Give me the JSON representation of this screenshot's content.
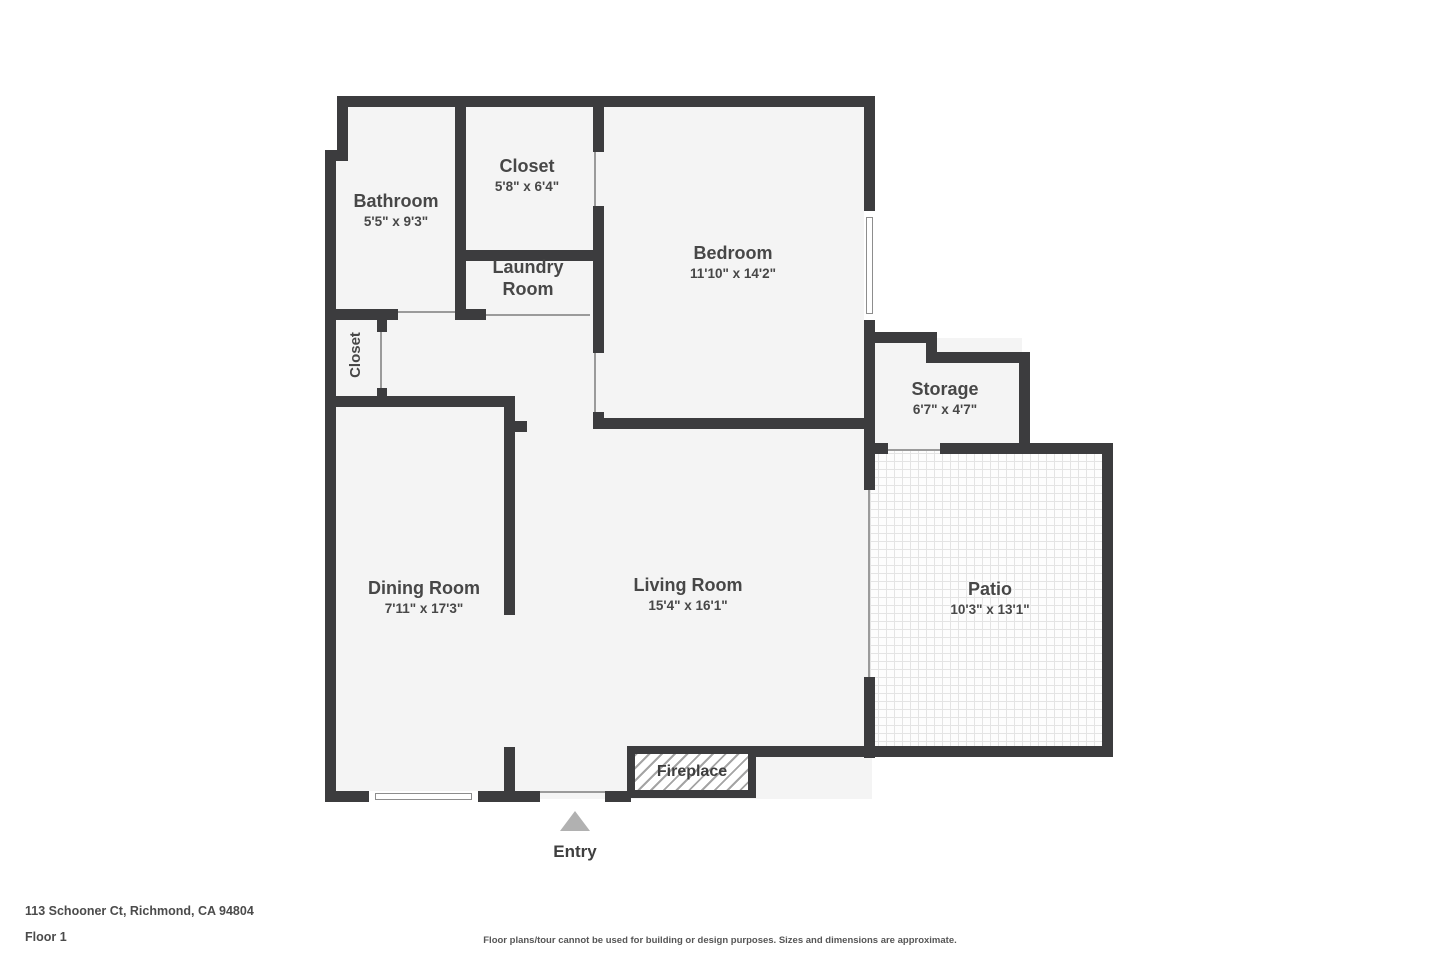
{
  "meta": {
    "type": "floor-plan"
  },
  "rooms": {
    "bathroom": {
      "name": "Bathroom",
      "dims": "5'5\" x 9'3\""
    },
    "bedroom_closet": {
      "name": "Closet",
      "dims": "5'8\" x 6'4\""
    },
    "laundry": {
      "name": "Laundry Room"
    },
    "bedroom": {
      "name": "Bedroom",
      "dims": "11'10\" x 14'2\""
    },
    "hall_closet": {
      "name": "Closet"
    },
    "storage": {
      "name": "Storage",
      "dims": "6'7\" x 4'7\""
    },
    "dining": {
      "name": "Dining Room",
      "dims": "7'11\" x 17'3\""
    },
    "living": {
      "name": "Living Room",
      "dims": "15'4\" x 16'1\""
    },
    "patio": {
      "name": "Patio",
      "dims": "10'3\" x 13'1\""
    }
  },
  "features": {
    "fireplace": "Fireplace",
    "entry": "Entry"
  },
  "footer": {
    "address": "113 Schooner Ct, Richmond, CA 94804",
    "floor": "Floor 1",
    "disclaimer": "Floor plans/tour cannot be used for building or design purposes. Sizes and dimensions are approximate."
  },
  "colors": {
    "wall": "#3c3c3e",
    "floor": "#f4f4f4",
    "label_text": "#474747",
    "entry_arrow": "#b1b1b1"
  }
}
